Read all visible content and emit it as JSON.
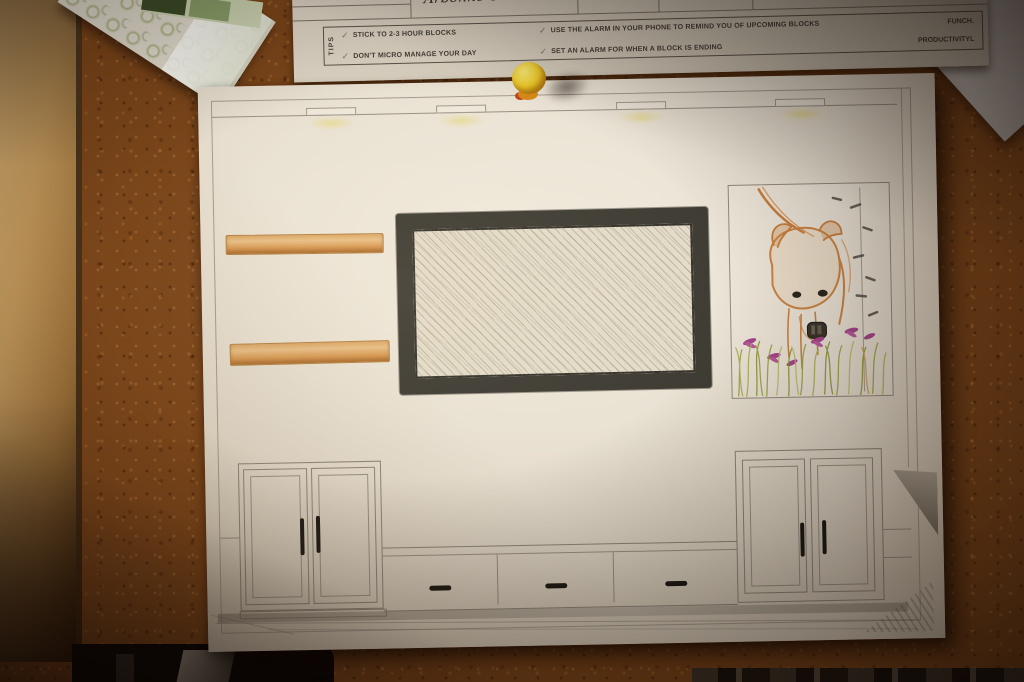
{
  "board": {
    "cork_color": "#7b461a",
    "wood_frame_color": "#c9a468",
    "pushpin_color": "#ecc928"
  },
  "tips_sheet": {
    "handwritten_note": "Arbonne Clients",
    "tips_label": "TIPS",
    "check_glyph": "✓",
    "items": [
      "STICK TO 2-3 HOUR BLOCKS",
      "DON'T MICRO MANAGE YOUR DAY",
      "USE THE ALARM IN YOUR PHONE TO REMIND YOU OF UPCOMING BLOCKS",
      "SET AN ALARM FOR WHEN A BLOCK IS ENDING"
    ],
    "brand_top": "FUNCH.",
    "brand_bottom": "PRODUCTIVITYL"
  },
  "drawing": {
    "subject": "media wall elevation sketch",
    "tv_frame_color": "#403d35",
    "shelf_color": "#d99a54",
    "ceiling_lights_count": 4,
    "ceiling_light_glow_color": "#e2d058",
    "left_cabinet_doors": 2,
    "right_cabinet_doors": 2,
    "bench_drawers": 3,
    "bear_artwork": {
      "subject": "bear among flowers and grass",
      "outline_color": "#c97f3e",
      "flower_color": "#a8468c",
      "grass_color": "#96a03c"
    }
  }
}
